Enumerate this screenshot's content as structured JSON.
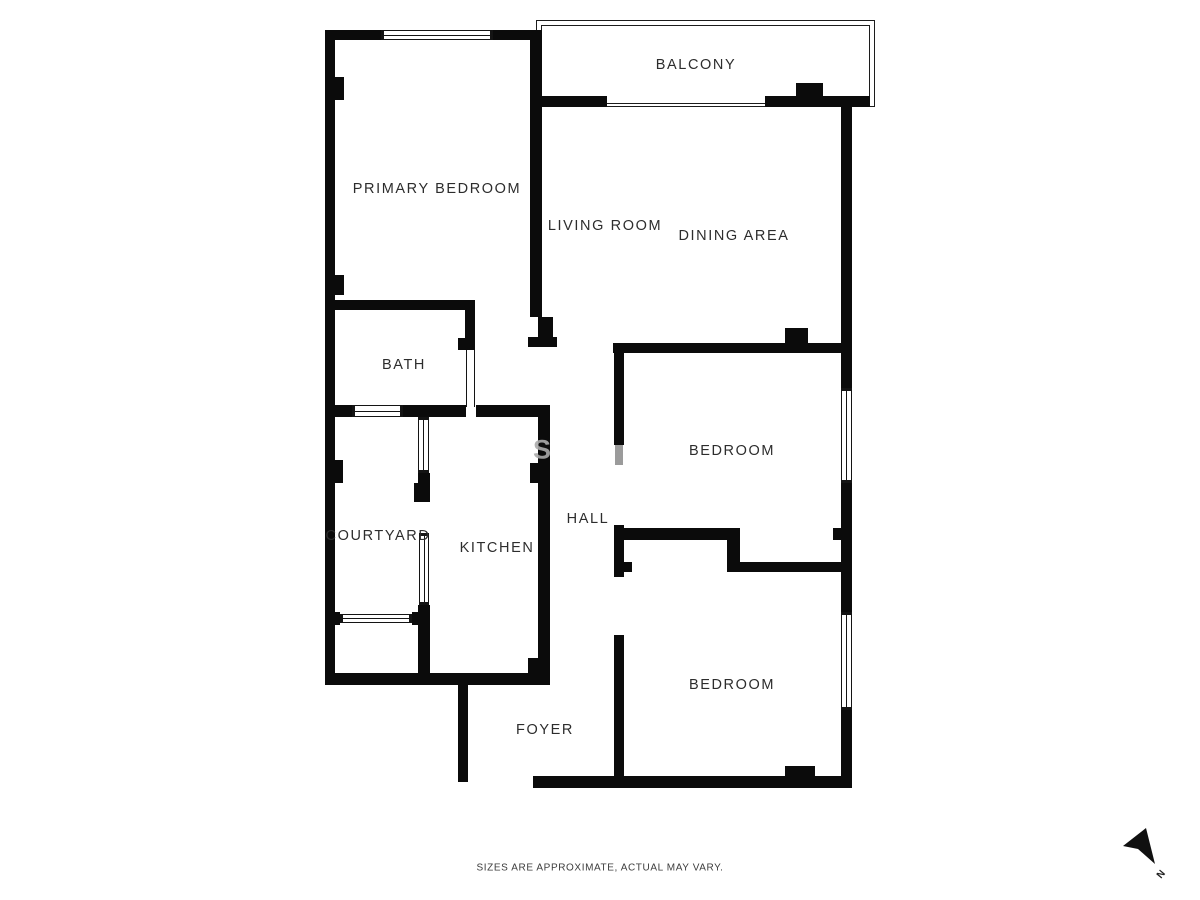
{
  "rooms": [
    {
      "label": "BALCONY"
    },
    {
      "label": "PRIMARY BEDROOM"
    },
    {
      "label": "LIVING ROOM"
    },
    {
      "label": "DINING AREA"
    },
    {
      "label": "BATH"
    },
    {
      "label": "COURTYARD"
    },
    {
      "label": "KITCHEN"
    },
    {
      "label": "HALL"
    },
    {
      "label": "BEDROOM"
    },
    {
      "label": "BEDROOM"
    },
    {
      "label": "FOYER"
    }
  ],
  "footer": {
    "disclaimer": "SIZES ARE APPROXIMATE, ACTUAL MAY VARY."
  },
  "compass": {
    "label": "N"
  },
  "watermark": {
    "text": "S"
  },
  "colors": {
    "wall": "#0b0b0b",
    "background": "#ffffff",
    "label": "#2d2d2d",
    "door": "#9b9b9b"
  }
}
